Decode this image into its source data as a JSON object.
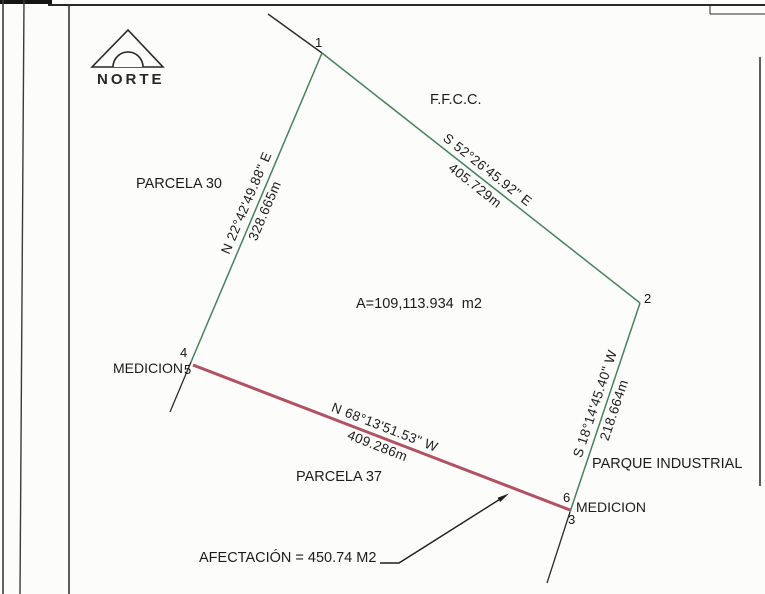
{
  "north": {
    "label": "NORTE"
  },
  "labels": {
    "parcela_30": "PARCELA 30",
    "parcela_37": "PARCELA 37",
    "ffcc": "F.F.C.C.",
    "area": "A=109,113.934  m2",
    "medicion_left": "MEDICION",
    "medicion_right": "MEDICION",
    "parque_industrial": "PARQUE INDUSTRIAL",
    "afectacion": "AFECTACIÓN = 450.74 M2"
  },
  "vertices": {
    "v1": "1",
    "v2": "2",
    "v3": "3",
    "v4": "4",
    "v5": "5",
    "v6": "6"
  },
  "dimensions": {
    "side_1_4": {
      "bearing": "N 22°42'49.88\" E",
      "distance": "328.665m"
    },
    "side_1_2": {
      "bearing": "S 52°26'45.92\" E",
      "distance": "405.729m"
    },
    "side_2_6": {
      "bearing": "S 18°14'45.40\" W",
      "distance": "218.664m"
    },
    "side_5_6": {
      "bearing": "N 68°13'51.53\" W",
      "distance": "409.286m"
    }
  },
  "colors": {
    "boundary_green": "#47805f",
    "affected_red": "#b05263",
    "ink": "#1c1c1c"
  }
}
